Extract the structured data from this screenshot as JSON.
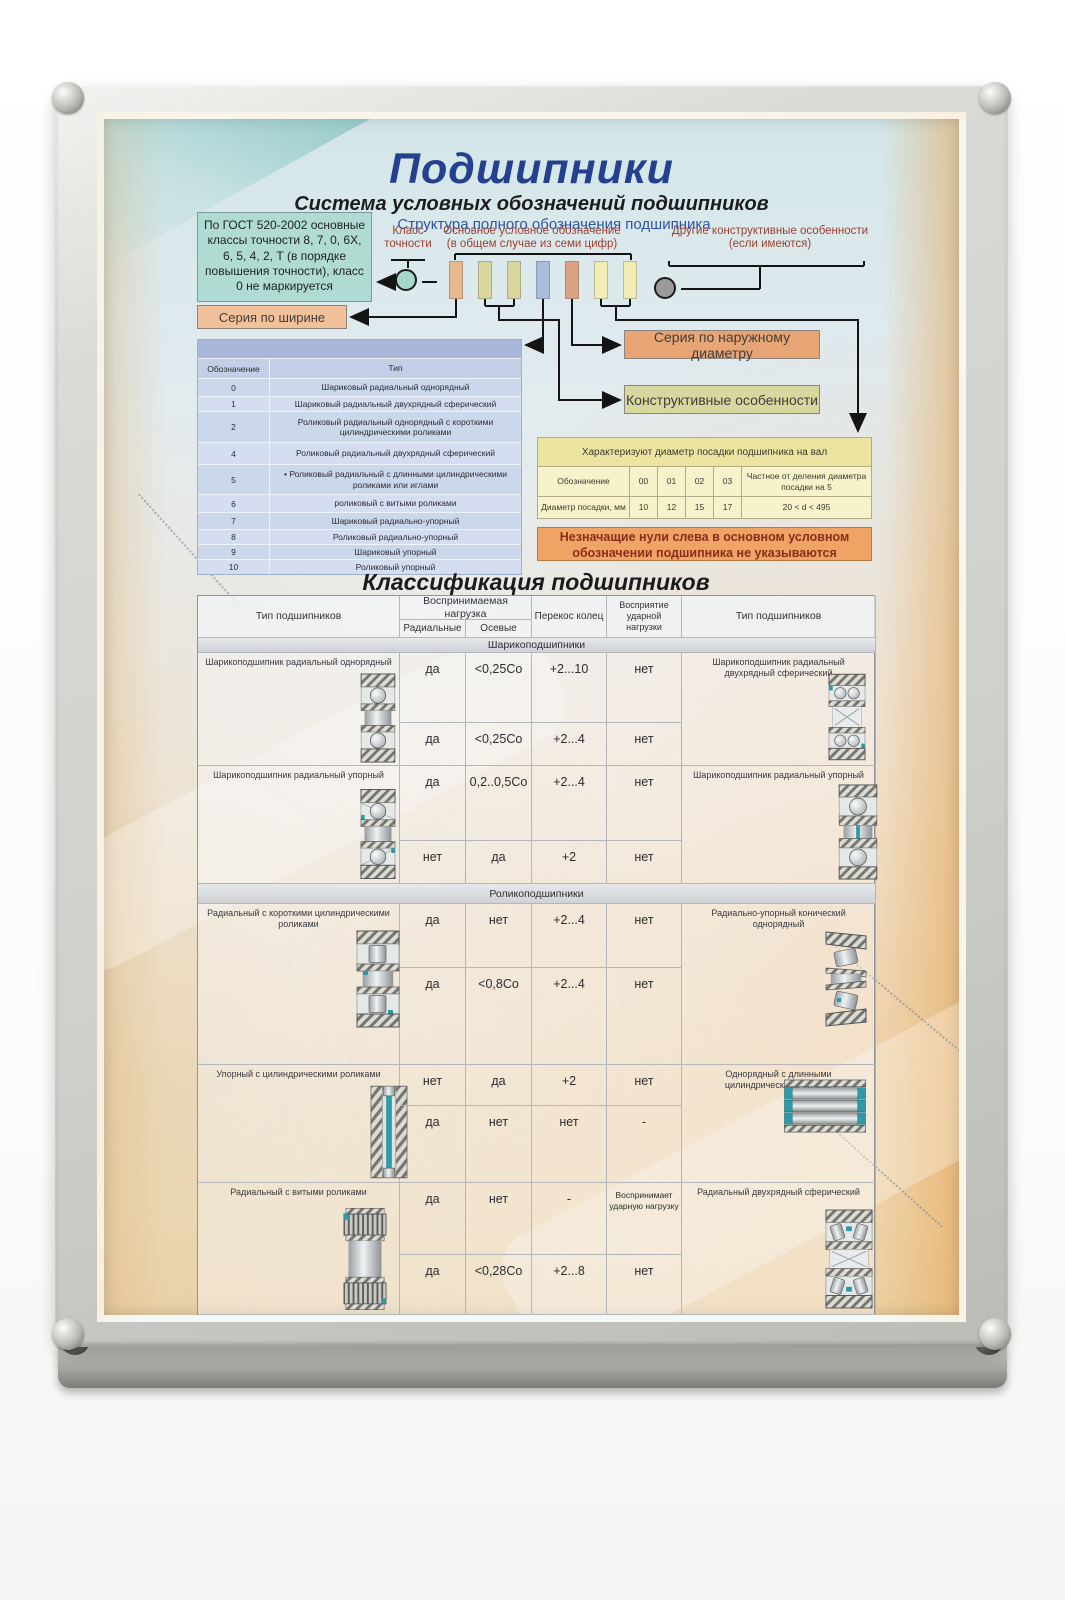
{
  "poster": {
    "title": "Подшипники",
    "subtitle": "Система условных обозначений подшипников",
    "structure": {
      "heading": "Структура полного обозначения подшипника",
      "gost_note": "По ГОСТ 520-2002 основные классы точности 8, 7, 0, 6Х, 6, 5, 4, 2, Т (в порядке повышения точности), класс 0 не маркируется",
      "accuracy_class_label": "Класс точности",
      "main_designation_label": "Основное условное обозначение (в общем случае из семи цифр)",
      "other_features_label": "Другие конструктивные особенности (если имеются)",
      "width_series_box": "Серия по ширине",
      "outer_diameter_box": "Серия по наружному диаметру",
      "design_features_box": "Конструктивные особенности",
      "zero_note": "Незначащие нули слева в основном условном обозначении подшипника не указываются"
    },
    "type_table": {
      "col_designation": "Обозначение",
      "col_type": "Тип",
      "rows": [
        [
          "0",
          "Шариковый радиальный однорядный"
        ],
        [
          "1",
          "Шариковый радиальный двухрядный сферический"
        ],
        [
          "2",
          "Роликовый радиальный однорядный с короткими цилиндрическими роликами"
        ],
        [
          "4",
          "Роликовый радиальный двухрядный сферический"
        ],
        [
          "5",
          "•  Роликовый радиальный с длинными цилиндрическими роликами или иглами"
        ],
        [
          "6",
          "роликовый с витыми роликами"
        ],
        [
          "7",
          "Шариковый радиально-упорный"
        ],
        [
          "8",
          "Роликовый радиально-упорный"
        ],
        [
          "9",
          "Шариковый упорный"
        ],
        [
          "10",
          "Роликовый упорный"
        ]
      ]
    },
    "diameter_table": {
      "title": "Характеризуют диаметр посадки подшипника на вал",
      "rows": [
        [
          "Обозначение",
          "00",
          "01",
          "02",
          "03",
          "Частное от деления диаметра посадки на 5"
        ],
        [
          "Диаметр посадки, мм",
          "10",
          "12",
          "15",
          "17",
          "20 < d < 495"
        ]
      ]
    },
    "classification": {
      "title": "Классификация подшипников",
      "header": {
        "type_left": "Тип подшипников",
        "load": "Воспринимаемая нагрузка",
        "radial": "Радиальные",
        "axial": "Осевые",
        "misalignment": "Перекос колец",
        "shock": "Восприятие ударной нагрузки",
        "type_right": "Тип подшипников"
      },
      "sections": [
        {
          "name": "Шарикоподшипники",
          "blocks": [
            {
              "type_left": "Шарикоподшипник радиальный однорядный",
              "type_right": "Шарикоподшипник радиальный двухрядный сферический",
              "rows": [
                [
                  "да",
                  "<0,25Со",
                  "+2...10",
                  "нет"
                ],
                [
                  "да",
                  "<0,25Со",
                  "+2...4",
                  "нет"
                ]
              ]
            },
            {
              "type_left": "Шарикоподшипник радиальный упорный",
              "type_right": "Шарикоподшипник радиальный упорный",
              "rows": [
                [
                  "да",
                  "0,2..0,5Со",
                  "+2...4",
                  "нет"
                ],
                [
                  "нет",
                  "да",
                  "+2",
                  "нет"
                ]
              ]
            }
          ]
        },
        {
          "name": "Роликоподшипники",
          "blocks": [
            {
              "type_left": "Радиальный с короткими цилиндрическими роликами",
              "type_right": "Радиально-упорный конический однорядный",
              "rows": [
                [
                  "да",
                  "нет",
                  "+2...4",
                  "нет"
                ],
                [
                  "да",
                  "<0,8Со",
                  "+2...4",
                  "нет"
                ]
              ]
            },
            {
              "type_left": "Упорный с  цилиндрическими роликами",
              "type_right": "Однорядный с длинными цилиндрическими иглами",
              "rows": [
                [
                  "нет",
                  "да",
                  "+2",
                  "нет"
                ],
                [
                  "да",
                  "нет",
                  "нет",
                  "-"
                ]
              ]
            },
            {
              "type_left": "Радиальный с витыми роликами",
              "type_right": "Радиальный двухрядный сферический",
              "rows": [
                [
                  "да",
                  "нет",
                  "-",
                  "Воспринимает ударную нагрузку"
                ],
                [
                  "да",
                  "<0,28Со",
                  "+2...8",
                  "нет"
                ]
              ]
            }
          ]
        }
      ]
    },
    "colors": {
      "title_blue": "#24418f",
      "label_red": "#9c4030",
      "gost_teal": "#afdbd3",
      "width_series_orange": "#f1c19b",
      "outer_diameter_orange": "#e7a474",
      "features_khaki": "#d8d79f",
      "note_orange": "#efa365",
      "type_table_blue": "#cbd7eb",
      "diameter_table_yellow": "#f6f2ca",
      "digit_cells": [
        "#e9b98e",
        "#d9d79e",
        "#d9d79e",
        "#a9bcdc",
        "#dba284",
        "#f2edb4",
        "#f2edb4"
      ],
      "bearing_accent_teal": "#2e9aa8"
    },
    "icons": {
      "b1_left": "bearing-ball-radial-single-icon",
      "b1_right": "bearing-ball-double-spherical-icon",
      "b2_left": "bearing-ball-angular-contact-icon",
      "b2_right": "bearing-ball-thrust-icon",
      "r1_left": "bearing-cylindrical-roller-icon",
      "r1_right": "bearing-tapered-roller-icon",
      "r2_left": "bearing-thrust-cylindrical-roller-icon",
      "r2_right": "bearing-needle-roller-icon",
      "r3_left": "bearing-spiral-roller-icon",
      "r3_right": "bearing-spherical-roller-double-icon"
    }
  }
}
